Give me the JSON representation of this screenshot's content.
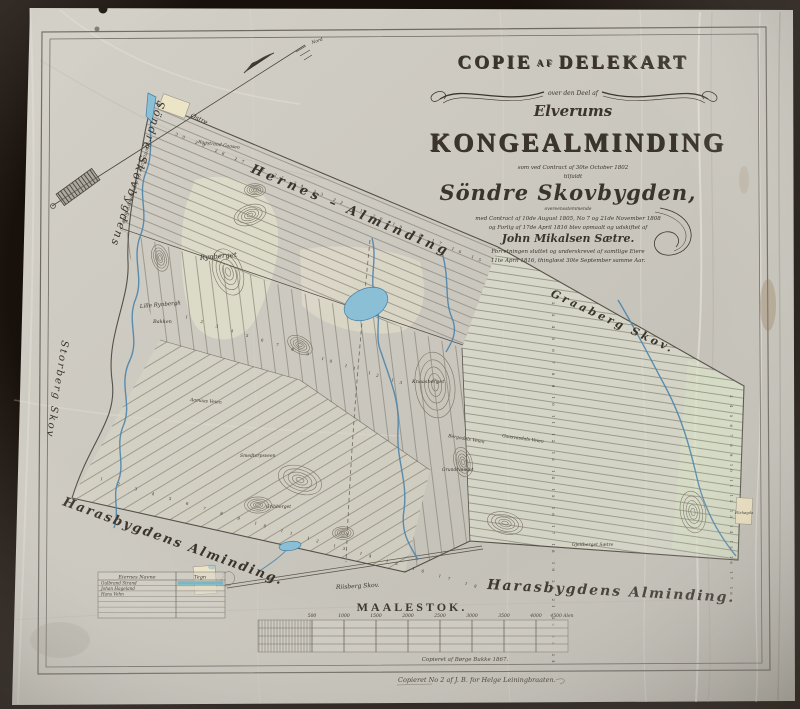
{
  "title_block": {
    "copie": "COPIE",
    "af": "AF",
    "delekart": "DELEKART",
    "over": "over den Deel af",
    "elverums": "Elverums",
    "main": "KONGEALMINDING",
    "small1": "som ved Contract af 30te October 1802",
    "small2": "tilfaldt",
    "name": "Söndre Skovbygden,",
    "small3": "overeensstemmende",
    "small4": "med Contract af 10de August 1805, No 7 og 21de November 1808",
    "small5": "og Forlig af 17de April 1816 blev opmaalt og udskiftet af",
    "surveyor": "John Mikalsen Sætre.",
    "small6": "Forretningen sluttet og underskrevet af samtlige Eiere",
    "small7": "11te April 1816, thinglæst 30te September samme Aar."
  },
  "compass": {
    "north_label": "Nord"
  },
  "scalebar": {
    "title": "MAALESTOK.",
    "ticks": [
      "500",
      "1000",
      "1500",
      "2000",
      "2500",
      "3000",
      "3500",
      "4000",
      "4500 Alen"
    ]
  },
  "legend": {
    "headers": [
      "Eiernes Navne",
      "Tegn"
    ],
    "rows": [
      "Gulbrand Strand",
      "Johan Hageland",
      "Hans Vehn"
    ]
  },
  "signatures": {
    "line1": "Copieret af Børge Bukke 1867.",
    "line2": "Copieret No 2 af J. B. for Helge Leiningbraaten."
  },
  "labels": {
    "hernes": "Hernes – Alminding",
    "graaberg": "Graaberg  Skov.",
    "haras_sw": "Harasbygdens Alminding.",
    "haras_s": "Harasbygdens  Alminding.",
    "skovbygdens": "Söndre Skovbygdens",
    "hjemskove": "Hjemskove til den søndre Side",
    "storberg": "Storberg Skov",
    "rynberget": "Rynberget",
    "lille_rynberg": "Lille Rynbergh",
    "bakken": "Bakken",
    "knaasberget": "Knaasberget",
    "bergedals": "Bergedals Veien",
    "riisberg": "Riisberg Skov.",
    "rogstrand": "Rogstrand-Gaasen",
    "ostre": "Østre",
    "flishogda": "Flishøgda",
    "gaasvasdals": "Gaasvasdals Veien",
    "gjeitberget": "Gjeitberget Sætre",
    "grundtvandet": "Grundtvandet",
    "smedtorpsveen": "Smedtorpsveen",
    "gribberget": "Gribberget",
    "aamaas": "Aamaas Veien",
    "nord": "Nord"
  },
  "strip_numbers": {
    "nw": "30 29 28 27 26 25 24 23 22 21 20 19 18 17 16 15",
    "center": "1 2 3 4 5 6 7 8 9 10 11 12 13",
    "east": "2 3 4 5 6 7 8 9 10 11 12 13 14 15 16 17 18 19 20 21 22 23 24",
    "east_right": "3 4 5 6 7 8 9 10 11 12 13 14 15 16 17 18",
    "sw": "1 2 3 4 5 6 7 8 9 10 11 12 13 14 15 16 17 18"
  },
  "colors": {
    "ink": "#2f2a24",
    "river": "#4c84ab",
    "lake_fill": "#8abfd6",
    "cloth": "#cac7be",
    "legend_swatch": "#73b5c5"
  }
}
